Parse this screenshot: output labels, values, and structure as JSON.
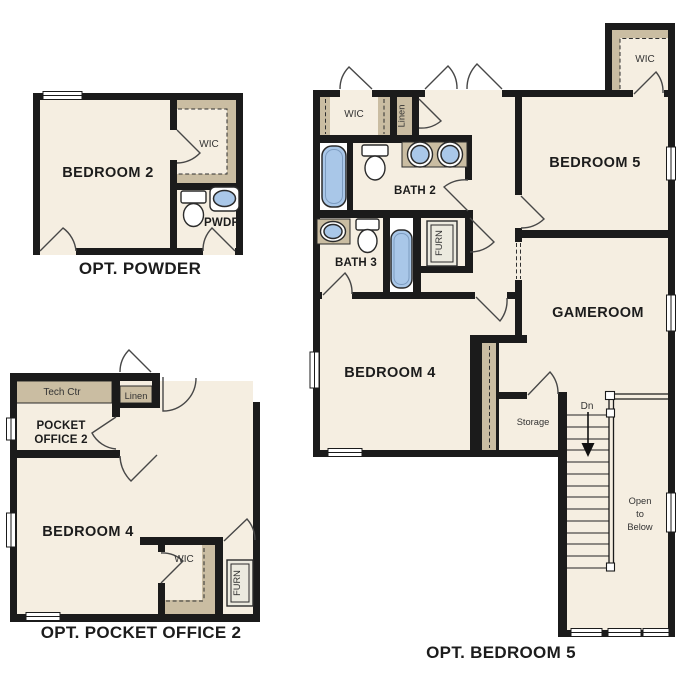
{
  "document_type": "floor-plan-options",
  "colors": {
    "wall": "#1b1b1b",
    "floor": "#f5eee1",
    "closet_tan": "#cabda2",
    "fixture_blue": "#a9c7e8"
  },
  "plans": {
    "opt_powder": {
      "title": "OPT. POWDER",
      "bedroom2": "BEDROOM 2",
      "wic": "WIC",
      "pwdr": "PWDR"
    },
    "opt_pocket_office_2": {
      "title": "OPT. POCKET OFFICE 2",
      "tech_ctr": "Tech Ctr",
      "linen": "Linen",
      "pocket_office_line1": "POCKET",
      "pocket_office_line2": "OFFICE 2",
      "bedroom4": "BEDROOM 4",
      "wic": "WIC",
      "furn": "FURN"
    },
    "opt_bedroom_5": {
      "title": "OPT. BEDROOM 5",
      "wic_hall": "WIC",
      "linen": "Linen",
      "bath2": "BATH 2",
      "bedroom5": "BEDROOM 5",
      "wic_bedroom5": "WIC",
      "bath3": "BATH 3",
      "furn": "FURN",
      "gameroom": "GAMEROOM",
      "bedroom4": "BEDROOM 4",
      "storage": "Storage",
      "dn": "Dn",
      "open_line1": "Open",
      "open_line2": "to",
      "open_line3": "Below"
    }
  }
}
